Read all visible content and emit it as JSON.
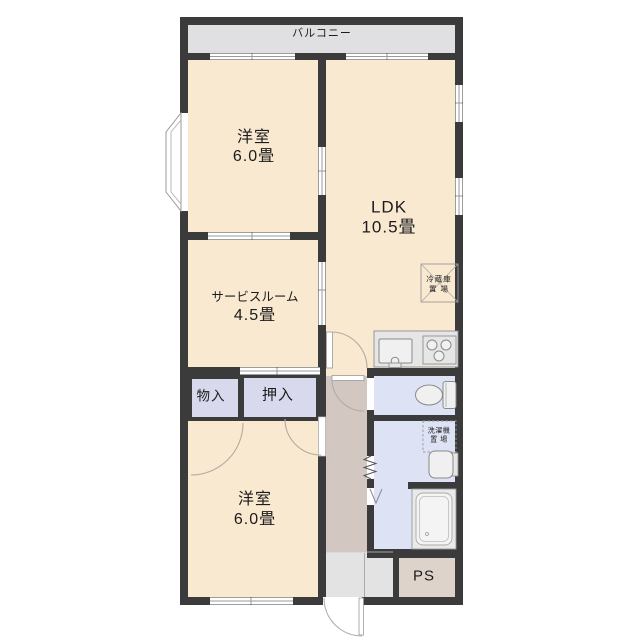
{
  "plan": {
    "balcony_label": "バルコニー",
    "rooms": {
      "western_top": {
        "name": "洋室",
        "size": "6.0畳"
      },
      "ldk": {
        "name": "LDK",
        "size": "10.5畳"
      },
      "service": {
        "name": "サービスルーム",
        "size": "4.5畳"
      },
      "western_bottom": {
        "name": "洋室",
        "size": "6.0畳"
      }
    },
    "storage": {
      "monoire": "物入",
      "oshiire": "押入",
      "pipe_space": "PS"
    },
    "appliance_spaces": {
      "refrigerator": {
        "line1": "冷蔵庫",
        "line2": "置 場"
      },
      "washing_machine": {
        "line1": "洗濯機",
        "line2": "置 場"
      }
    },
    "colors": {
      "room_floor": "#f8e9d0",
      "closet": "#d8d9ed",
      "wet_area": "#dde2f4",
      "hallway": "#d2c8c1",
      "entry": "#e3e3e3",
      "balcony": "#e0e0e2",
      "pipe_space": "#ded3cb",
      "wall": "#3b3b3b"
    }
  }
}
